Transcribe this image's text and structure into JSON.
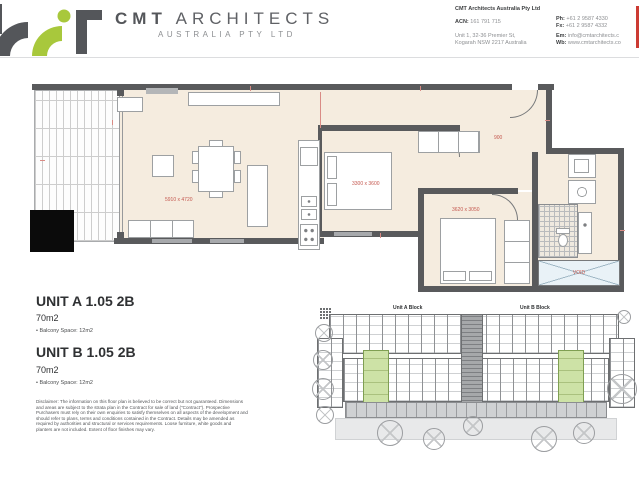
{
  "header": {
    "brand": {
      "name_bold": "CMT",
      "name_rest": "ARCHITECTS",
      "subtitle": "AUSTRALIA PTY LTD"
    },
    "info": {
      "company": "CMT Architects Australia Pty Ltd",
      "acn_label": "ACN:",
      "acn": "161 791 715",
      "address1": "Unit 1, 32-36 Premier St,",
      "address2": "Kogarah NSW 2217 Australia",
      "contacts": [
        {
          "label": "Ph:",
          "value": "+61 2 9587 4330"
        },
        {
          "label": "Fx:",
          "value": "+61 2 9587 4332"
        },
        {
          "label": "Em:",
          "value": "info@cmtarchitects.c"
        },
        {
          "label": "Wb:",
          "value": "www.cmtarchitects.co"
        }
      ]
    }
  },
  "floor_plan": {
    "dims": {
      "living": "5910 x 4720",
      "bed1": "3300 x 3600",
      "bed2": "3620 x 3050",
      "entry": "900",
      "void": "VOID"
    }
  },
  "units": [
    {
      "title": "UNIT A 1.05 2B",
      "area": "70m2",
      "balcony": "• Balcony Space: 12m2"
    },
    {
      "title": "UNIT B 1.05 2B",
      "area": "70m2",
      "balcony": "• Balcony Space: 12m2"
    }
  ],
  "disclaimer": "Disclaimer:  The information on this floor plan is believed to be correct but not guaranteed. Dimensions and areas are subject to the strata plan in the Contract for sale of land (\"Contract\"). Prospective Purchasers must rely on their own enquiries to satisfy themselves on all aspects of the development and should refer to plans, terms and conditions contained in the Contract. Details may be amended as required by authorities and structural or services requirements. Loose furniture, white goods and planters are not included.  Extent of floor finishes may vary.",
  "site_plan": {
    "block_a": "Unit A Block",
    "block_b": "Unit B Block"
  }
}
